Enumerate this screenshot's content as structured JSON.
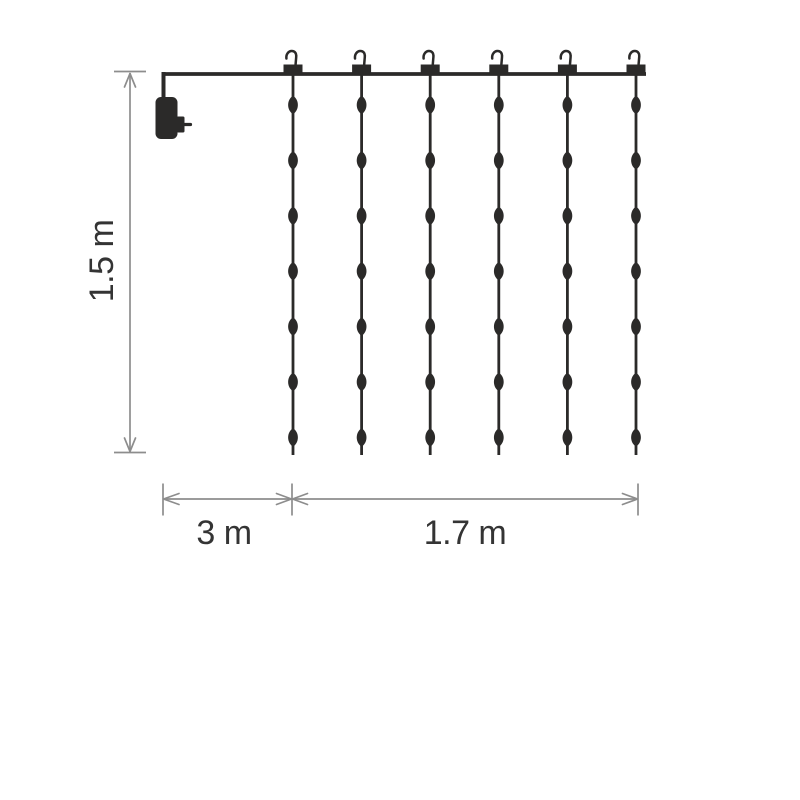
{
  "diagram": {
    "colors": {
      "background": "#ffffff",
      "ink": "#2b2a29",
      "dimension_lines": "#8d8d8d",
      "labels": "#343434"
    },
    "curtain": {
      "hook_count": 6,
      "string_count": 6,
      "leds_per_string": 7
    },
    "dimensions": {
      "height_label": "1.5 m",
      "lead_label": "3 m",
      "width_label": "1.7 m"
    },
    "icons": {
      "power_adapter": "power-adapter-icon",
      "hanger": "hanger-hook-icon",
      "led": "led-bulb-icon"
    }
  }
}
